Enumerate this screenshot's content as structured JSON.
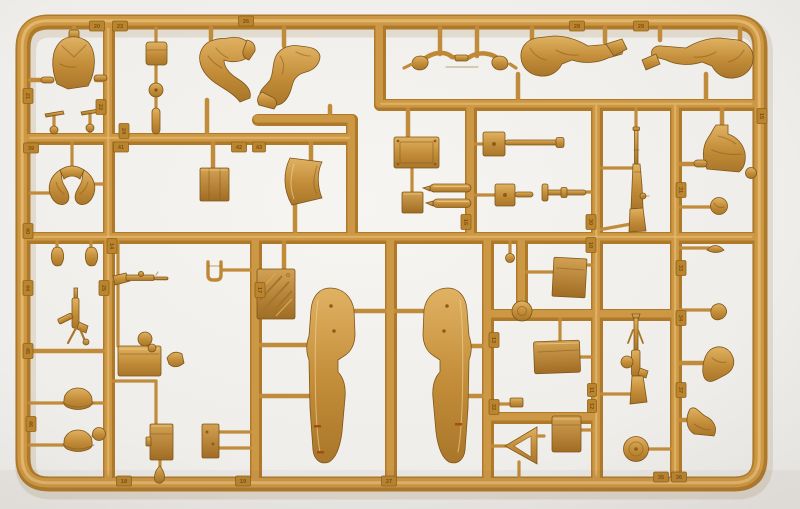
{
  "image_type": "photograph",
  "subject": "Tan injection-molded polystyrene model-kit sprue (parts frame) with motorcycle, sidecar and figure parts, photographed on a plain light background",
  "colors": {
    "plastic_mid": "#C6913C",
    "plastic_highlight": "#E8C277",
    "plastic_shadow": "#8A5E1D",
    "background": "#EFEDE9",
    "paint_mark": "#A14E12"
  },
  "tabs": [
    {
      "n": "20"
    },
    {
      "n": "23"
    },
    {
      "n": "26"
    },
    {
      "n": "28"
    },
    {
      "n": "29"
    },
    {
      "n": "15"
    },
    {
      "n": "21"
    },
    {
      "n": "22"
    },
    {
      "n": "24"
    },
    {
      "n": "39"
    },
    {
      "n": "41"
    },
    {
      "n": "42"
    },
    {
      "n": "43"
    },
    {
      "n": "40"
    },
    {
      "n": "14"
    },
    {
      "n": "44"
    },
    {
      "n": "25"
    },
    {
      "n": "45"
    },
    {
      "n": "46"
    },
    {
      "n": "18"
    },
    {
      "n": "19"
    },
    {
      "n": "27"
    },
    {
      "n": "16"
    },
    {
      "n": "30"
    },
    {
      "n": "10"
    },
    {
      "n": "31"
    },
    {
      "n": "33"
    },
    {
      "n": "34"
    },
    {
      "n": "37"
    },
    {
      "n": "11"
    },
    {
      "n": "12"
    },
    {
      "n": "35"
    },
    {
      "n": "36"
    },
    {
      "n": "17"
    },
    {
      "n": "13"
    },
    {
      "n": "32"
    }
  ],
  "parts": [
    {
      "id": "torso-jacket",
      "desc": "figure torso in tunic"
    },
    {
      "id": "gear-lever-left",
      "desc": "small T-shaped control lever"
    },
    {
      "id": "gear-lever-right",
      "desc": "small T-shaped control lever"
    },
    {
      "id": "small-pouch",
      "desc": "rectangular pouch"
    },
    {
      "id": "knob-disc",
      "desc": "round damper knob"
    },
    {
      "id": "post-with-collar",
      "desc": "small cylindrical post"
    },
    {
      "id": "rider-leg-left",
      "desc": "bent rider leg with boot"
    },
    {
      "id": "rider-leg-right",
      "desc": "bent rider leg with boot"
    },
    {
      "id": "handlebars-with-hands",
      "desc": "handlebar with gloved hands"
    },
    {
      "id": "seated-legs-1",
      "desc": "pair of seated legs"
    },
    {
      "id": "seated-legs-2",
      "desc": "pair of seated legs, mirrored"
    },
    {
      "id": "seated-torso",
      "desc": "leaning rider torso"
    },
    {
      "id": "head",
      "desc": "bare head"
    },
    {
      "id": "side-cap",
      "desc": "field side cap"
    },
    {
      "id": "small-disc",
      "desc": "small disc"
    },
    {
      "id": "right-hand",
      "desc": "gloved hand"
    },
    {
      "id": "bent-arm",
      "desc": "bent arm"
    },
    {
      "id": "boot-leg",
      "desc": "lower leg with boot"
    },
    {
      "id": "arms-pair",
      "desc": "pair of bent arms"
    },
    {
      "id": "gloved-hand-left",
      "desc": "small gloved hand"
    },
    {
      "id": "gloved-hand-right",
      "desc": "small gloved hand"
    },
    {
      "id": "rifle-horizontal",
      "desc": "bolt-action rifle, horizontal"
    },
    {
      "id": "mp40-submachine-gun",
      "desc": "submachine gun with magazine"
    },
    {
      "id": "helmet-1",
      "desc": "steel helmet"
    },
    {
      "id": "helmet-2",
      "desc": "steel helmet"
    },
    {
      "id": "canteen-ball",
      "desc": "round canteen"
    },
    {
      "id": "front-fork",
      "desc": "U-shaped fork"
    },
    {
      "id": "stowage-crate",
      "desc": "wooden-style crate"
    },
    {
      "id": "seat-backrest",
      "desc": "curved saddle / backrest panel"
    },
    {
      "id": "embossed-plaque",
      "desc": "plate with diagonal embossing (illegible)"
    },
    {
      "id": "fender-left",
      "desc": "large motorcycle fender half"
    },
    {
      "id": "fender-right",
      "desc": "large motorcycle fender half, mirrored"
    },
    {
      "id": "jerry-can",
      "desc": "fuel can with handle"
    },
    {
      "id": "filler-spout",
      "desc": "can spout"
    },
    {
      "id": "round-pot",
      "desc": "small round pot"
    },
    {
      "id": "ammo-box",
      "desc": "ammunition box with clasp"
    },
    {
      "id": "radio-box",
      "desc": "small equipment box"
    },
    {
      "id": "teardrop-pouch",
      "desc": "small teardrop part"
    },
    {
      "id": "flat-sheet",
      "desc": "square flat sheet"
    },
    {
      "id": "luggage-rack",
      "desc": "rack plate with screw holes"
    },
    {
      "id": "small-plate",
      "desc": "small flat plate"
    },
    {
      "id": "exhaust-mufflers",
      "desc": "two exhaust muffler pipes"
    },
    {
      "id": "wheel-axle",
      "desc": "axle with mounting plate"
    },
    {
      "id": "brake-hub",
      "desc": "hub with stub axle"
    },
    {
      "id": "t-axle",
      "desc": "axle rod with T head"
    },
    {
      "id": "hand-lever",
      "desc": "small lever with ball end"
    },
    {
      "id": "brake-drum",
      "desc": "round brake drum"
    },
    {
      "id": "kar98k-rifle",
      "desc": "bolt-action rifle, vertical"
    },
    {
      "id": "mg34-machine-gun",
      "desc": "machine gun with drum magazine, vertical"
    },
    {
      "id": "stowage-panel",
      "desc": "large flat stowage panel"
    },
    {
      "id": "stowage-box",
      "desc": "square stowage box"
    },
    {
      "id": "warning-triangle",
      "desc": "triangular frame"
    },
    {
      "id": "spare-wheel-disc",
      "desc": "solid disc wheel"
    },
    {
      "id": "small-bracket",
      "desc": "small bracket"
    }
  ]
}
